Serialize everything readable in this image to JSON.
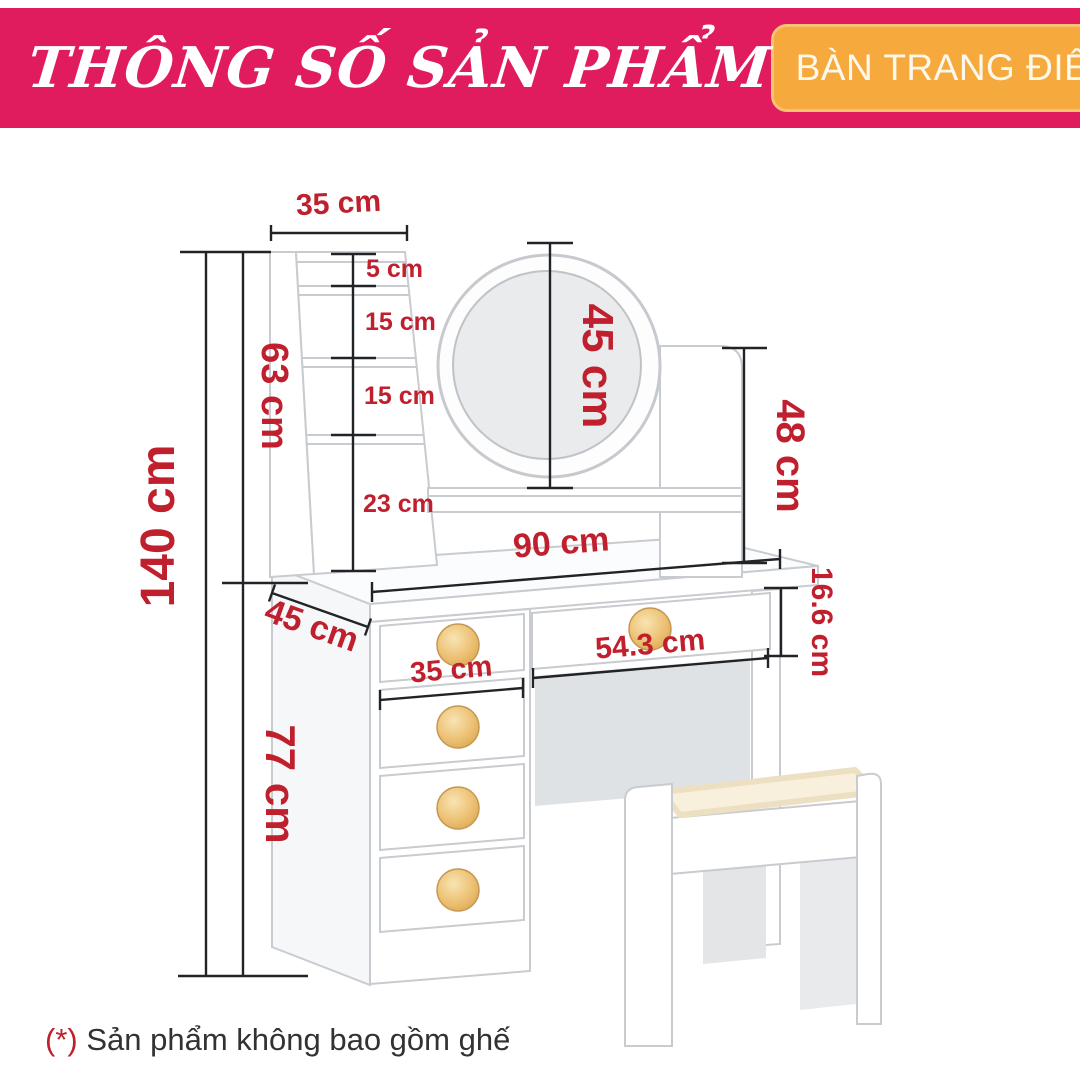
{
  "header": {
    "title": "THÔNG SỐ SẢN PHẨM",
    "badge": "BÀN TRANG ĐIỂM: MERCURY"
  },
  "footnote": {
    "marker": "(*)",
    "text": " Sản phẩm không bao gồm ghế"
  },
  "diagram": {
    "product": "vanity dressing table with round mirror, ladder shelf, five drawers and stool",
    "dimensions": {
      "total_height": "140 cm",
      "upper_section_height": "63 cm",
      "lower_section_height": "77 cm",
      "shelf_tower_width": "35 cm",
      "shelf_gap_1": "5 cm",
      "shelf_gap_2": "15 cm",
      "shelf_gap_3": "15 cm",
      "shelf_gap_4": "23 cm",
      "mirror_diameter": "45 cm",
      "mirror_panel_height": "48 cm",
      "tabletop_width": "90 cm",
      "tabletop_depth": "45 cm",
      "drawer_height": "16.6 cm",
      "middle_drawer_width": "54.3 cm",
      "side_drawer_width": "35 cm"
    }
  },
  "colors": {
    "header_pink": "#E01B5E",
    "badge_orange": "#F6A93D",
    "dimension_red": "#C01F2E",
    "line_dark": "#212326",
    "knob_gold": "#EDC175",
    "cushion_cream": "#F8F0DD",
    "mirror_glass": "#E9EBED"
  }
}
